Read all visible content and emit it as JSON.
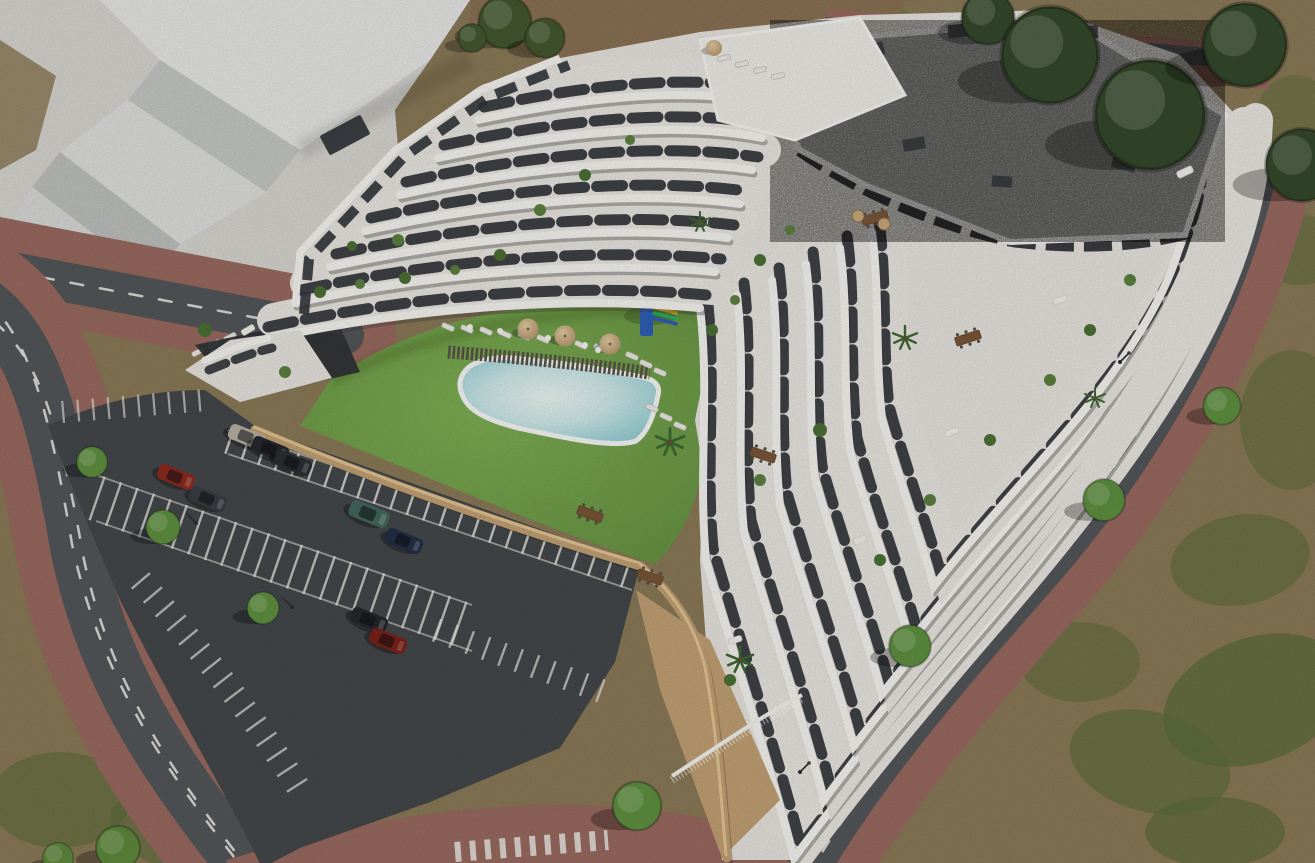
{
  "scene": {
    "description": "Aerial 3D architectural rendering of a modern terraced white apartment complex with wavy balcony bands, a gravel flat roof, rooftop terraces with plants and furniture, a central lawn courtyard with a freeform swimming pool, sun loungers, parasols and a playground, an open-air parking lot with cars, all bounded by curving asphalt roads with red paved sidewalks, street trees and surrounding scrubland; a large light-gray stepped neighboring building occupies the upper-left corner.",
    "time_of_day": "daytime",
    "palette": {
      "scrub": "#8b7a58",
      "scrub_green": "#5a6c3a",
      "dirt": "#8a7254",
      "plaza": "#d7d6d1",
      "neighbor_top": "#e7e8e5",
      "neighbor_face": "#c6c8c5",
      "road": "#54575a",
      "road_line": "#eceae6",
      "sidewalk": "#996a60",
      "parking": "#45484b",
      "bay_line": "#edece6",
      "lawn": "#6f9f48",
      "pool_water": "#aedade",
      "pool_rim": "#f7f9f7",
      "deck": "#5a554a",
      "wall_tan": "#c2a174",
      "building_white": "#f6f5f1",
      "terrace_floor": "#e8e5df",
      "facade_dark": "#303438",
      "roof_gravel": "#a5a6a2",
      "tree_dark": "#35492b",
      "tree_bright": "#5f9140",
      "umbrella_tan": "#c9ac7e",
      "umbrella_white": "#f6f4ef",
      "table_wood": "#7a5638",
      "sofa_light": "#f2f1ec"
    },
    "counts": {
      "cars": 9,
      "street_trees": 7,
      "large_trees": 5,
      "bushes": 5,
      "tan_umbrellas": 4,
      "white_parasols": 5,
      "sun_loungers": 22,
      "dining_tables": 5,
      "outdoor_sofas": 6,
      "hanging_chairs": 2,
      "street_lamps": 4,
      "playgrounds": 1,
      "pools": 1
    },
    "cars": [
      {
        "color": "silver",
        "hex": "#b7b1a4"
      },
      {
        "color": "black",
        "hex": "#26292d"
      },
      {
        "color": "black",
        "hex": "#2c2f33"
      },
      {
        "color": "red",
        "hex": "#8e2a20"
      },
      {
        "color": "graphite",
        "hex": "#3a3e43"
      },
      {
        "color": "teal-green",
        "hex": "#44685c"
      },
      {
        "color": "navy",
        "hex": "#232f47"
      },
      {
        "color": "black",
        "hex": "#25282c"
      },
      {
        "color": "dark-red",
        "hex": "#7c211a"
      }
    ],
    "playground": {
      "tower": "#2e5fb8",
      "slide_stripes": [
        "#c0392b",
        "#e8b020",
        "#27ae60",
        "#2e5fb8"
      ]
    },
    "pool": {
      "shape": "freeform",
      "water_center": "#e9f5f2",
      "water_edge": "#93ccd1"
    }
  }
}
